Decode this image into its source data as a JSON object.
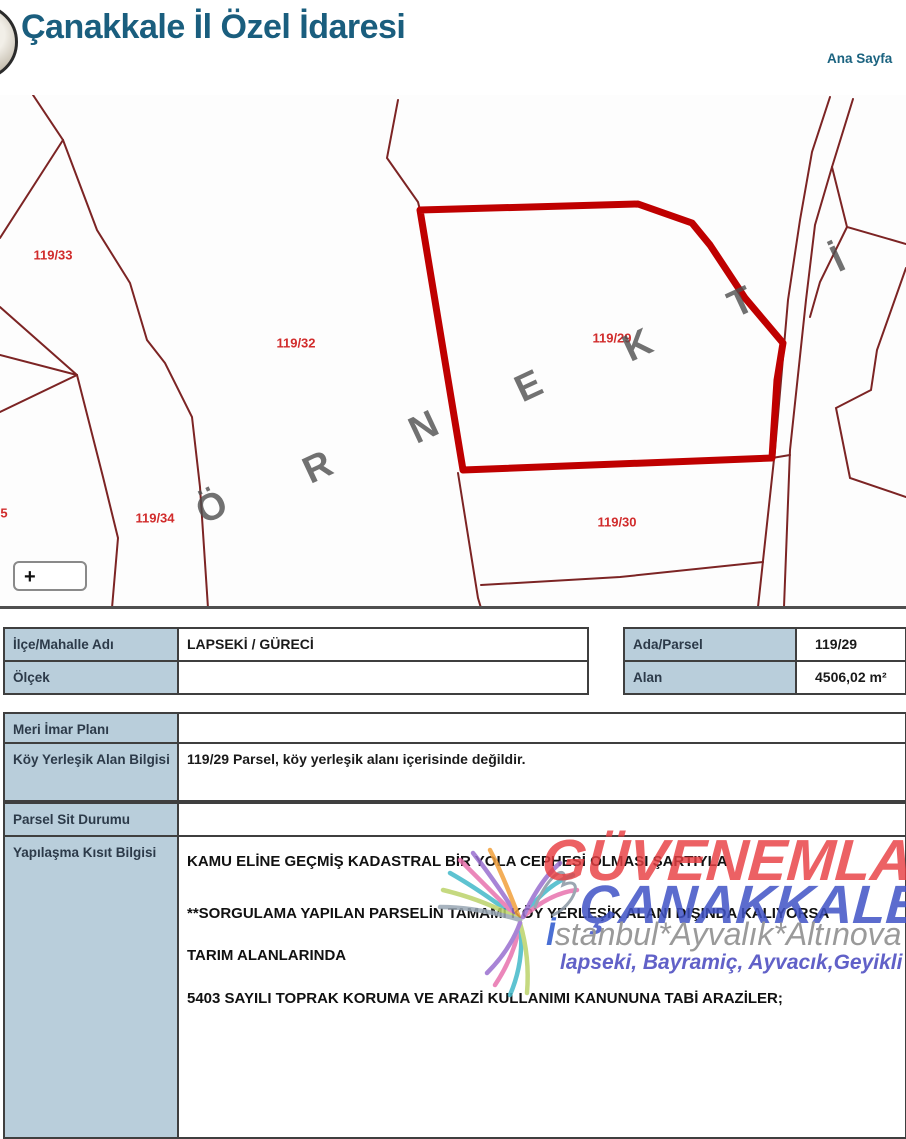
{
  "header": {
    "title": "Çanakkale İl Özel İdaresi",
    "nav_home": "Ana Sayfa"
  },
  "map": {
    "parcel_labels": [
      {
        "id": "119-33",
        "label": "119/33"
      },
      {
        "id": "119-32",
        "label": "119/32"
      },
      {
        "id": "119-29",
        "label": "119/29"
      },
      {
        "id": "119-34",
        "label": "119/34"
      },
      {
        "id": "119-30",
        "label": "119/30"
      },
      {
        "id": "edge-partial",
        "label": "5"
      }
    ],
    "watermark_letters": [
      "Ö",
      "R",
      "N",
      "E",
      "K",
      "T",
      "İ",
      "R"
    ],
    "zoom_button_label": "+",
    "highlight_color": "#bf0000",
    "line_color": "#7c2424",
    "label_color": "#d12c2c"
  },
  "info_table": {
    "left_rows": [
      {
        "label": "İlçe/Mahalle Adı",
        "value": "LAPSEKİ / GÜRECİ"
      },
      {
        "label": "Ölçek",
        "value": ""
      }
    ],
    "right_rows": [
      {
        "label": "Ada/Parsel",
        "value": "119/29"
      },
      {
        "label": "Alan",
        "value": "4506,02 m²"
      }
    ]
  },
  "detail_table": [
    {
      "label": "Meri İmar Planı",
      "value": ""
    },
    {
      "label": "Köy Yerleşik Alan Bilgisi",
      "value": "119/29 Parsel, köy yerleşik alanı içerisinde değildir."
    },
    {
      "label": "Parsel Sit Durumu",
      "value": ""
    },
    {
      "label": "Yapılaşma Kısıt Bilgisi",
      "lines": [
        "KAMU ELİNE GEÇMİŞ KADASTRAL BİR YOLA CEPHESİ OLMASI ŞARTIYLA",
        "**SORGULAMA YAPILAN PARSELİN TAMAMI KÖY YERLEŞİK ALANI DIŞINDA KALIYORSA",
        "TARIM ALANLARINDA",
        "5403 SAYILI TOPRAK KORUMA VE ARAZİ KULLANIMI KANUNUNA TABİ ARAZİLER;"
      ]
    }
  ],
  "watermark_overlay": {
    "line1": "GÜVENEMLAK",
    "line2": "ÇANAKKALE",
    "line3_prefix": "İ",
    "line3_rest": "stanbul*Ayvalık*Altınova",
    "line4": "lapseki, Bayramiç, Ayvacık,Geyikli",
    "red": "#e83e42",
    "blue": "#3f52c6"
  }
}
